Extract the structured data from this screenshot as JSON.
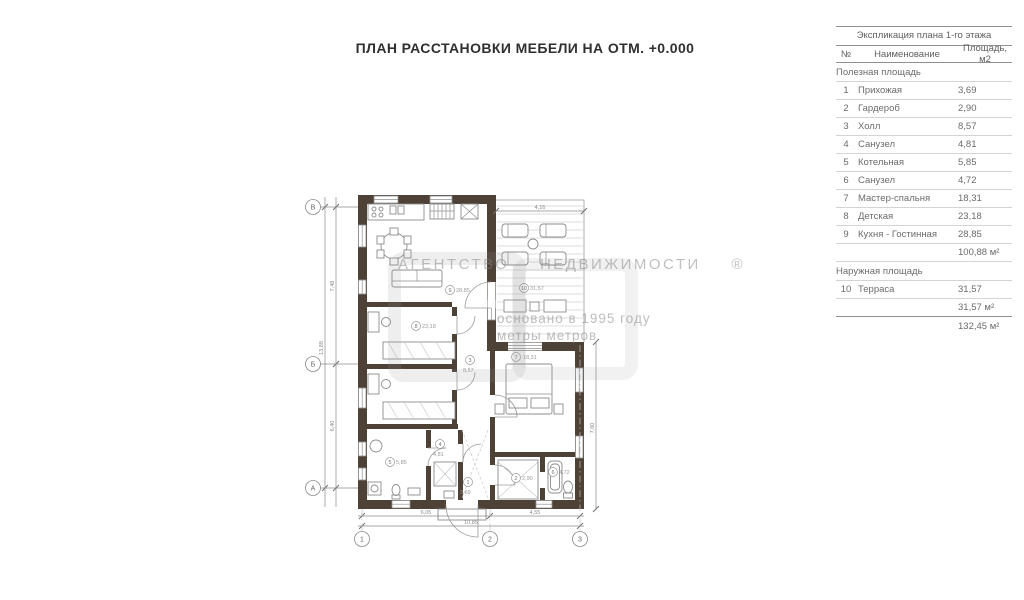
{
  "title": "ПЛАН РАССТАНОВКИ МЕБЕЛИ НА ОТМ. +0.000",
  "watermark": {
    "agency": "АГЕНТСТВО НЕДВИЖИМОСТИ ®",
    "founded": "основано в 1995 году",
    "brand": "метры метров"
  },
  "table": {
    "title": "Экспликация плана 1-го этажа",
    "columns": {
      "num": "№",
      "name": "Наименование",
      "area": "Площадь, м2"
    },
    "sections": [
      {
        "label": "Полезная площадь",
        "rows": [
          [
            "1",
            "Прихожая",
            "3,69"
          ],
          [
            "2",
            "Гардероб",
            "2,90"
          ],
          [
            "3",
            "Холл",
            "8,57"
          ],
          [
            "4",
            "Санузел",
            "4,81"
          ],
          [
            "5",
            "Котельная",
            "5,85"
          ],
          [
            "6",
            "Санузел",
            "4,72"
          ],
          [
            "7",
            "Мастер-спальня",
            "18,31"
          ],
          [
            "8",
            "Детская",
            "23,18"
          ],
          [
            "9",
            "Кухня - Гостинная",
            "28,85"
          ]
        ],
        "subtotal": "100,88 м²"
      },
      {
        "label": "Наружная площадь",
        "rows": [
          [
            "10",
            "Терраса",
            "31,57"
          ]
        ],
        "subtotal": "31,57 м²"
      }
    ],
    "total": "132,45 м²"
  },
  "plan": {
    "axes_bottom": [
      "1",
      "2",
      "3"
    ],
    "axes_left": [
      "В",
      "Б",
      "А"
    ],
    "dims": {
      "b1": "6,05",
      "b2": "4,55",
      "b_total": "10,85",
      "l1": "7,48",
      "l2": "6,40",
      "l_total": "13,88",
      "t1": "4,16",
      "r1": "7,60"
    },
    "rooms": [
      {
        "n": "1",
        "a": "3,69"
      },
      {
        "n": "2",
        "a": "2,90"
      },
      {
        "n": "3",
        "a": "8,57"
      },
      {
        "n": "4",
        "a": "4,81"
      },
      {
        "n": "5",
        "a": "5,85"
      },
      {
        "n": "6",
        "a": "4,72"
      },
      {
        "n": "7",
        "a": "18,31"
      },
      {
        "n": "8",
        "a": "23,18"
      },
      {
        "n": "9",
        "a": "28,85"
      },
      {
        "n": "10",
        "a": "31,57"
      }
    ]
  }
}
